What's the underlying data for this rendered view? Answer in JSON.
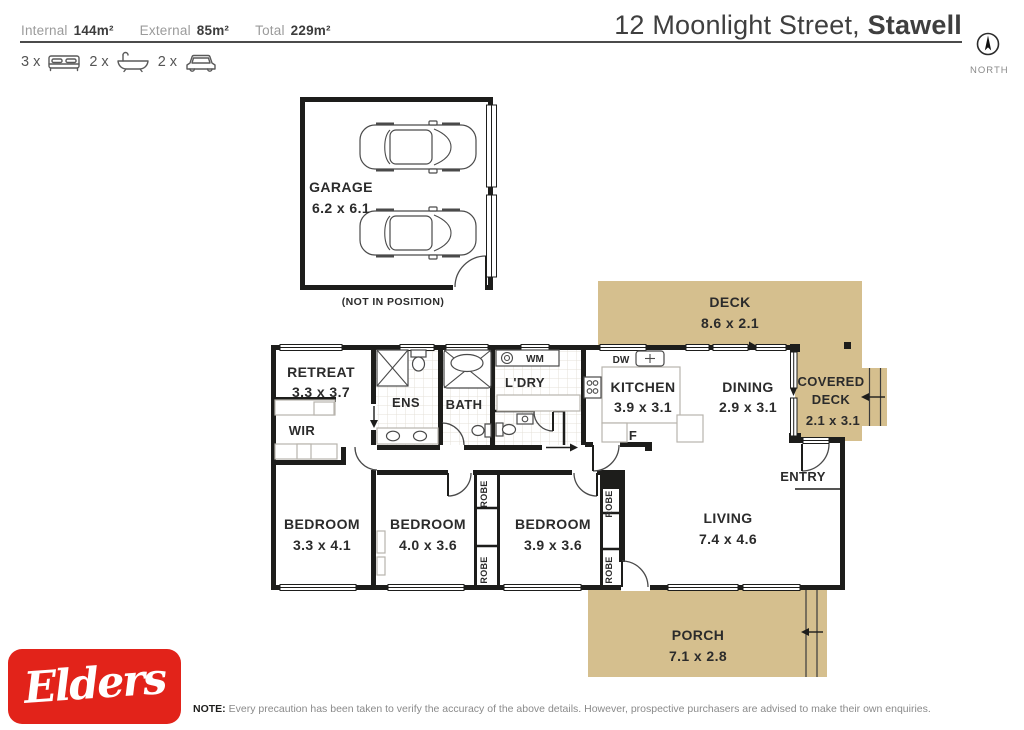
{
  "header": {
    "stats": [
      {
        "label": "Internal",
        "value": "144m²"
      },
      {
        "label": "External",
        "value": "85m²"
      },
      {
        "label": "Total",
        "value": "229m²"
      }
    ],
    "title_regular": "12 Moonlight Street, ",
    "title_bold": "Stawell",
    "north_label": "NORTH",
    "features": [
      {
        "count": "3 x",
        "icon": "bed-icon"
      },
      {
        "count": "2 x",
        "icon": "bath-icon"
      },
      {
        "count": "2 x",
        "icon": "car-icon"
      }
    ]
  },
  "plan": {
    "garage": {
      "name": "GARAGE",
      "dims": "6.2 x 6.1",
      "note": "(NOT IN POSITION)"
    },
    "deck": {
      "name": "DECK",
      "dims": "8.6 x 2.1"
    },
    "covered_deck": {
      "name_line1": "COVERED",
      "name_line2": "DECK",
      "dims": "2.1 x 3.1"
    },
    "retreat": {
      "name": "RETREAT",
      "dims": "3.3 x 3.7"
    },
    "wir": {
      "name": "WIR"
    },
    "ens": {
      "name": "ENS"
    },
    "bath": {
      "name": "BATH"
    },
    "laundry": {
      "name": "L'DRY",
      "wm": "WM"
    },
    "kitchen": {
      "name": "KITCHEN",
      "dims": "3.9 x 3.1",
      "dw": "DW",
      "fridge": "F"
    },
    "dining": {
      "name": "DINING",
      "dims": "2.9 x 3.1"
    },
    "entry": {
      "name": "ENTRY"
    },
    "living": {
      "name": "LIVING",
      "dims": "7.4 x 4.6"
    },
    "bedroom1": {
      "name": "BEDROOM",
      "dims": "3.3 x 4.1"
    },
    "bedroom2": {
      "name": "BEDROOM",
      "dims": "4.0 x 3.6"
    },
    "bedroom3": {
      "name": "BEDROOM",
      "dims": "3.9 x 3.6"
    },
    "robe": "ROBE",
    "porch": {
      "name": "PORCH",
      "dims": "7.1 x 2.8"
    }
  },
  "footer": {
    "logo_text": "Elders",
    "note_label": "NOTE:",
    "note_text": "Every precaution has been taken to verify the accuracy of the above details. However, prospective purchasers are advised to make their own enquiries."
  },
  "colors": {
    "deck_fill": "#d5bf8e",
    "wall": "#1d1d1b",
    "logo_red": "#e2231a",
    "label_text": "#2b2b2b"
  }
}
